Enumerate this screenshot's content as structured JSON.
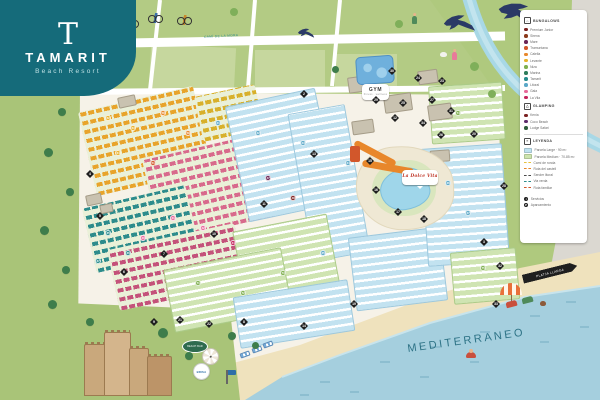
{
  "logo": {
    "initial": "T",
    "title": "TAMARIT",
    "subtitle": "Beach Resort"
  },
  "map": {
    "sea_label": "MEDITERRANEO",
    "road_label": "CAMÍ DE LA MORA",
    "colors": {
      "teal_brand": "#156B7A",
      "sea": "#A5CFDE",
      "sand": "#EFE2BD",
      "field": "#B3CB84",
      "interior": "#F6F2E8",
      "marker": "#1F1F1F"
    }
  },
  "legend": {
    "sections": [
      {
        "icon": "bungalow",
        "title": "BUNGALOWS",
        "items": [
          {
            "c": "#7A2020",
            "label": "Premium Junior"
          },
          {
            "c": "#8C3A1B",
            "label": "Sirena"
          },
          {
            "c": "#6B2457",
            "label": "Mare"
          },
          {
            "c": "#D2572B",
            "label": "Tramuntana"
          },
          {
            "c": "#E8872B",
            "label": "Calella"
          },
          {
            "c": "#E8B22B",
            "label": "Levante"
          },
          {
            "c": "#7FAF4F",
            "label": "Niza"
          },
          {
            "c": "#2F7D5B",
            "label": "Marina"
          },
          {
            "c": "#278C8C",
            "label": "Tamarit"
          },
          {
            "c": "#5BA8C8",
            "label": "Litoral"
          },
          {
            "c": "#E86A9A",
            "label": "Gala"
          },
          {
            "c": "#C4245C",
            "label": "La Vila"
          }
        ]
      },
      {
        "icon": "glamping",
        "title": "GLAMPING",
        "items": [
          {
            "c": "#7A2020",
            "label": "Kenia"
          },
          {
            "c": "#5D2B6B",
            "label": "Coco Beach"
          },
          {
            "c": "#2F5D3B",
            "label": "Lodge Safari"
          }
        ]
      },
      {
        "divider": true,
        "icon": "leyenda",
        "title": "LEYENDA",
        "items": [
          {
            "k": "swatch",
            "c": "#BFE2F0",
            "label": "Parcela Large · 90 m²"
          },
          {
            "k": "swatch",
            "c": "#CDE4AE",
            "label": "Parcela Medium · 70-85 m²"
          },
          {
            "k": "line",
            "c": "#E8C23A",
            "label": "Camí de ronda"
          },
          {
            "k": "line",
            "c": "#E8872B",
            "label": "Ruta del castell"
          },
          {
            "k": "line",
            "c": "#4A4A4A",
            "label": "Sender litoral"
          },
          {
            "k": "line",
            "c": "#2D8C8C",
            "label": "Via verda"
          },
          {
            "k": "line",
            "c": "#D2572B",
            "label": "Ruta familiar"
          }
        ]
      },
      {
        "gap": true,
        "items": [
          {
            "k": "pin",
            "g": "i",
            "label": "Servicios"
          },
          {
            "k": "pin",
            "g": "P",
            "label": "Aparcamiento"
          }
        ]
      }
    ]
  },
  "items": [
    {
      "t": "zone-orange",
      "x": 86,
      "y": 98,
      "w": 118,
      "h": 86,
      "r": -13,
      "c": "#E8A42B",
      "n": "bungalow-zone-orange"
    },
    {
      "t": "zone-orange",
      "x": 198,
      "y": 90,
      "w": 62,
      "h": 46,
      "r": -12,
      "c": "#D8B02B",
      "n": "bungalow-zone-yellow"
    },
    {
      "t": "zone-pink",
      "x": 150,
      "y": 146,
      "w": 118,
      "h": 84,
      "r": -13,
      "c": "#D86A8C",
      "n": "bungalow-zone-pink"
    },
    {
      "t": "zone-teal",
      "x": 88,
      "y": 196,
      "w": 106,
      "h": 66,
      "r": -13,
      "c": "#2D8C8C",
      "n": "bungalow-zone-teal"
    },
    {
      "t": "zone-pink",
      "x": 112,
      "y": 236,
      "w": 130,
      "h": 62,
      "r": -12,
      "c": "#C4527A",
      "n": "bungalow-zone-magenta"
    },
    {
      "t": "zone-blue",
      "x": 236,
      "y": 96,
      "w": 92,
      "h": 118,
      "r": -12,
      "n": "mobilehome-zone"
    },
    {
      "t": "zone-blue",
      "x": 300,
      "y": 108,
      "w": 58,
      "h": 150,
      "r": -10,
      "n": "mobilehome-zone"
    },
    {
      "t": "zone-green",
      "x": 238,
      "y": 222,
      "w": 96,
      "h": 70,
      "r": -11,
      "n": "camping-zone"
    },
    {
      "t": "zone-green",
      "x": 168,
      "y": 258,
      "w": 120,
      "h": 64,
      "r": -11,
      "n": "camping-zone"
    },
    {
      "t": "zone-blue",
      "x": 236,
      "y": 288,
      "w": 116,
      "h": 52,
      "r": -9,
      "n": "mobilehome-zone"
    },
    {
      "t": "zone-blue",
      "x": 352,
      "y": 232,
      "w": 92,
      "h": 74,
      "r": -7,
      "n": "mobilehome-zone"
    },
    {
      "t": "zone-green",
      "x": 430,
      "y": 84,
      "w": 74,
      "h": 58,
      "r": -4,
      "n": "camping-zone"
    },
    {
      "t": "zone-blue",
      "x": 424,
      "y": 146,
      "w": 82,
      "h": 118,
      "r": -4,
      "n": "mobilehome-zone"
    },
    {
      "t": "zone-green",
      "x": 452,
      "y": 250,
      "w": 66,
      "h": 52,
      "r": -5,
      "n": "camping-zone"
    },
    {
      "t": "building",
      "x": 348,
      "y": 76,
      "w": 26,
      "h": 16,
      "r": -8
    },
    {
      "t": "building",
      "x": 384,
      "y": 94,
      "w": 28,
      "h": 18,
      "r": -8
    },
    {
      "t": "building",
      "x": 418,
      "y": 70,
      "w": 20,
      "h": 14,
      "r": -8
    },
    {
      "t": "building",
      "x": 352,
      "y": 120,
      "w": 22,
      "h": 14,
      "r": -8
    },
    {
      "t": "building",
      "x": 428,
      "y": 104,
      "w": 24,
      "h": 16,
      "r": -8
    },
    {
      "t": "building",
      "x": 86,
      "y": 194,
      "w": 16,
      "h": 11,
      "r": -12
    },
    {
      "t": "building",
      "x": 100,
      "y": 204,
      "w": 13,
      "h": 9,
      "r": -12
    },
    {
      "t": "building",
      "x": 118,
      "y": 96,
      "w": 18,
      "h": 11,
      "r": -12
    },
    {
      "t": "building",
      "x": 430,
      "y": 150,
      "w": 20,
      "h": 12,
      "r": -4
    },
    {
      "t": "aqua",
      "x": 356,
      "y": 56,
      "w": 38,
      "h": 28,
      "r": -4,
      "n": "waterpark"
    },
    {
      "t": "deck",
      "x": 356,
      "y": 146,
      "w": 98,
      "h": 84,
      "r": -3,
      "n": "pool-deck"
    },
    {
      "t": "lawn",
      "x": 372,
      "y": 160,
      "w": 64,
      "h": 56
    },
    {
      "t": "pool",
      "x": 380,
      "y": 168,
      "w": 50,
      "h": 42,
      "r": -8,
      "n": "lagoon-pool"
    },
    {
      "t": "slide",
      "x": 352,
      "y": 150,
      "w": 46,
      "h": 7,
      "r": 28,
      "n": "water-slide"
    },
    {
      "t": "slide",
      "x": 362,
      "y": 164,
      "w": 52,
      "h": 7,
      "r": 10,
      "n": "water-slide"
    },
    {
      "t": "slide-tower",
      "x": 350,
      "y": 146,
      "w": 10,
      "h": 16
    },
    {
      "t": "bubble",
      "x": 362,
      "y": 84,
      "w": 27,
      "h": 16,
      "l": "GYM",
      "l2": "fitness · wellness",
      "i": 1,
      "n": "gym-label"
    },
    {
      "t": "bubble bubble-rest",
      "x": 402,
      "y": 170,
      "w": 36,
      "h": 15,
      "l": "La Dolce Vita",
      "i": 1,
      "n": "restaurant-label"
    },
    {
      "t": "tower",
      "x": 84,
      "y": 344,
      "w": 22,
      "h": 52,
      "c": "#C9A87C",
      "n": "castle-tower"
    },
    {
      "t": "tower",
      "x": 104,
      "y": 332,
      "w": 27,
      "h": 64,
      "c": "#D4B58C",
      "n": "castle-keep"
    },
    {
      "t": "tower",
      "x": 129,
      "y": 348,
      "w": 20,
      "h": 48,
      "c": "#C9A87C",
      "n": "castle-tower"
    },
    {
      "t": "tower",
      "x": 147,
      "y": 356,
      "w": 25,
      "h": 40,
      "c": "#BC9468",
      "n": "castle-wall"
    },
    {
      "t": "oval-sign",
      "x": 182,
      "y": 340,
      "w": 26,
      "h": 13,
      "l": "BEACH BAR",
      "i": 1,
      "n": "beach-bar-sign"
    },
    {
      "t": "parasol-top",
      "x": 202,
      "y": 348,
      "w": 17,
      "h": 17,
      "n": "parasol-top-view"
    },
    {
      "t": "brand-badge",
      "x": 193,
      "y": 363,
      "w": 17,
      "h": 17,
      "l": "BRISA",
      "i": 1,
      "n": "brisa-badge"
    },
    {
      "t": "flagpole",
      "x": 226,
      "y": 370,
      "w": 1.6,
      "h": 14,
      "n": "flag"
    },
    {
      "t": "lounger",
      "x": 240,
      "y": 352,
      "w": 10,
      "h": 5,
      "r": -20
    },
    {
      "t": "lounger",
      "x": 252,
      "y": 347,
      "w": 10,
      "h": 5,
      "r": -20
    },
    {
      "t": "lounger",
      "x": 263,
      "y": 342,
      "w": 10,
      "h": 5,
      "r": -20
    },
    {
      "t": "arrow-sign",
      "x": 522,
      "y": 268,
      "w": 56,
      "h": 9,
      "r": -14,
      "l": "PLATJA LLARGA",
      "i": 1,
      "n": "beach-direction-sign"
    },
    {
      "t": "parasol",
      "x": 500,
      "y": 283,
      "w": 22,
      "h": 12,
      "n": "beach-parasol"
    },
    {
      "t": "chair",
      "x": 506,
      "y": 301,
      "w": 11,
      "h": 6,
      "r": -15,
      "c": "#C94F3D",
      "n": "deck-chair"
    },
    {
      "t": "chair",
      "x": 522,
      "y": 297,
      "w": 11,
      "h": 6,
      "r": -15,
      "c": "#4F8A5A",
      "n": "deck-chair"
    },
    {
      "t": "dog",
      "x": 540,
      "y": 301,
      "w": 6,
      "h": 5,
      "c": "#8C5A3A",
      "n": "dog"
    },
    {
      "t": "swimmer",
      "x": 466,
      "y": 352,
      "w": 10,
      "h": 6,
      "n": "swimmer"
    },
    {
      "t": "bike",
      "x": 124,
      "y": 18,
      "w": 15,
      "h": 10,
      "c": "#C94F3D",
      "n": "cyclist"
    },
    {
      "t": "bike",
      "x": 148,
      "y": 13,
      "w": 15,
      "h": 10,
      "c": "#3A6FA8",
      "n": "cyclist"
    },
    {
      "t": "bike",
      "x": 177,
      "y": 15,
      "w": 15,
      "h": 10,
      "c": "#C98A2B",
      "n": "cyclist"
    },
    {
      "t": "fig",
      "x": 412,
      "y": 16,
      "w": 5,
      "h": 8,
      "c": "#4F8A5A",
      "n": "walker"
    },
    {
      "t": "dog",
      "x": 440,
      "y": 52,
      "w": 7,
      "h": 5,
      "c": "#F2F2EE",
      "n": "goat"
    },
    {
      "t": "fig",
      "x": 452,
      "y": 52,
      "w": 5,
      "h": 8,
      "c": "#E87A9A",
      "n": "walker"
    },
    {
      "t": "bird",
      "x": 444,
      "y": 14,
      "w": 30,
      "h": 20,
      "r": -8,
      "n": "swallow-icon"
    },
    {
      "t": "bird",
      "x": 298,
      "y": 28,
      "w": 16,
      "h": 11,
      "r": -4,
      "n": "swallow-icon"
    },
    {
      "t": "bird over-legend",
      "x": 498,
      "y": 2,
      "w": 40,
      "h": 26,
      "r": 8,
      "n": "swallow-icon"
    },
    {
      "t": "tree",
      "x": 58,
      "y": 108,
      "w": 8,
      "h": 8
    },
    {
      "t": "tree",
      "x": 44,
      "y": 148,
      "w": 9,
      "h": 9
    },
    {
      "t": "tree",
      "x": 66,
      "y": 188,
      "w": 8,
      "h": 8
    },
    {
      "t": "tree",
      "x": 40,
      "y": 226,
      "w": 9,
      "h": 9
    },
    {
      "t": "tree",
      "x": 62,
      "y": 266,
      "w": 8,
      "h": 8
    },
    {
      "t": "tree",
      "x": 48,
      "y": 300,
      "w": 9,
      "h": 9
    },
    {
      "t": "tree",
      "x": 86,
      "y": 318,
      "w": 8,
      "h": 8
    },
    {
      "t": "tree",
      "x": 158,
      "y": 328,
      "w": 10,
      "h": 10
    },
    {
      "t": "tree",
      "x": 228,
      "y": 332,
      "w": 8,
      "h": 8
    },
    {
      "t": "tree",
      "x": 252,
      "y": 342,
      "w": 7,
      "h": 7
    },
    {
      "t": "tree",
      "x": 185,
      "y": 352,
      "w": 8,
      "h": 8
    },
    {
      "t": "tree",
      "x": 332,
      "y": 66,
      "w": 7,
      "h": 7
    },
    {
      "t": "tree2",
      "x": 105,
      "y": 14,
      "w": 9,
      "h": 9
    },
    {
      "t": "tree2",
      "x": 230,
      "y": 8,
      "w": 8,
      "h": 8
    },
    {
      "t": "tree2",
      "x": 395,
      "y": 20,
      "w": 8,
      "h": 8
    },
    {
      "t": "tree2",
      "x": 470,
      "y": 62,
      "w": 9,
      "h": 9
    },
    {
      "t": "tree2",
      "x": 545,
      "y": 40,
      "w": 8,
      "h": 8
    },
    {
      "t": "tree2",
      "x": 556,
      "y": 170,
      "w": 9,
      "h": 9
    },
    {
      "t": "tree2",
      "x": 565,
      "y": 200,
      "w": 8,
      "h": 8
    },
    {
      "t": "tree2",
      "x": 488,
      "y": 90,
      "w": 8,
      "h": 8
    },
    {
      "t": "diamond",
      "x": 82,
      "y": 85,
      "l": "1",
      "i": 1
    },
    {
      "t": "diamond",
      "x": 300,
      "y": 90,
      "l": "2",
      "i": 1
    },
    {
      "t": "diamond",
      "x": 388,
      "y": 67,
      "l": "30",
      "i": 1
    },
    {
      "t": "diamond",
      "x": 414,
      "y": 74,
      "l": "24",
      "i": 1
    },
    {
      "t": "diamond",
      "x": 438,
      "y": 77,
      "l": "23",
      "i": 1
    },
    {
      "t": "diamond",
      "x": 372,
      "y": 96,
      "l": "29",
      "i": 1
    },
    {
      "t": "diamond",
      "x": 399,
      "y": 99,
      "l": "25",
      "i": 1
    },
    {
      "t": "diamond",
      "x": 428,
      "y": 96,
      "l": "27",
      "i": 1
    },
    {
      "t": "diamond",
      "x": 447,
      "y": 107,
      "l": "31",
      "i": 1
    },
    {
      "t": "diamond",
      "x": 391,
      "y": 114,
      "l": "12",
      "i": 1
    },
    {
      "t": "diamond",
      "x": 419,
      "y": 119,
      "l": "34",
      "i": 1
    },
    {
      "t": "diamond",
      "x": 437,
      "y": 131,
      "l": "26",
      "i": 1
    },
    {
      "t": "diamond",
      "x": 366,
      "y": 157,
      "l": "15",
      "i": 1
    },
    {
      "t": "diamond",
      "x": 372,
      "y": 186,
      "l": "16",
      "i": 1
    },
    {
      "t": "diamond",
      "x": 394,
      "y": 208,
      "l": "17",
      "i": 1
    },
    {
      "t": "diamond",
      "x": 420,
      "y": 215,
      "l": "18",
      "i": 1
    },
    {
      "t": "diamond",
      "x": 310,
      "y": 150,
      "l": "13",
      "i": 1
    },
    {
      "t": "diamond",
      "x": 260,
      "y": 200,
      "l": "11",
      "i": 1
    },
    {
      "t": "diamond",
      "x": 210,
      "y": 230,
      "l": "10",
      "i": 1
    },
    {
      "t": "diamond",
      "x": 160,
      "y": 250,
      "l": "7",
      "i": 1
    },
    {
      "t": "diamond",
      "x": 120,
      "y": 268,
      "l": "6",
      "i": 1
    },
    {
      "t": "diamond",
      "x": 96,
      "y": 212,
      "l": "5",
      "i": 1
    },
    {
      "t": "diamond",
      "x": 86,
      "y": 170,
      "l": "4",
      "i": 1
    },
    {
      "t": "diamond",
      "x": 150,
      "y": 318,
      "l": "9",
      "i": 1
    },
    {
      "t": "diamond",
      "x": 176,
      "y": 316,
      "l": "21",
      "i": 1
    },
    {
      "t": "diamond",
      "x": 205,
      "y": 320,
      "l": "22",
      "i": 1
    },
    {
      "t": "diamond",
      "x": 240,
      "y": 318,
      "l": "8",
      "i": 1
    },
    {
      "t": "diamond",
      "x": 300,
      "y": 322,
      "l": "14",
      "i": 1
    },
    {
      "t": "diamond",
      "x": 350,
      "y": 300,
      "l": "19",
      "i": 1
    },
    {
      "t": "diamond",
      "x": 470,
      "y": 130,
      "l": "20",
      "i": 1
    },
    {
      "t": "diamond",
      "x": 500,
      "y": 182,
      "l": "28",
      "i": 1
    },
    {
      "t": "diamond",
      "x": 480,
      "y": 238,
      "l": "3",
      "i": 1
    },
    {
      "t": "diamond",
      "x": 496,
      "y": 262,
      "l": "32",
      "i": 1
    },
    {
      "t": "diamond",
      "x": 492,
      "y": 300,
      "l": "33",
      "i": 1
    },
    {
      "t": "badge",
      "x": 105,
      "y": 115,
      "c": "#E8B22B",
      "l": "62",
      "i": 1
    },
    {
      "t": "badge",
      "x": 130,
      "y": 125,
      "c": "#E8B22B",
      "l": "63",
      "i": 1
    },
    {
      "t": "badge",
      "x": 160,
      "y": 110,
      "c": "#E8872B",
      "l": "58",
      "i": 1
    },
    {
      "t": "badge",
      "x": 185,
      "y": 130,
      "c": "#E8872B",
      "l": "59",
      "i": 1
    },
    {
      "t": "badge",
      "x": 115,
      "y": 150,
      "c": "#E8B22B",
      "l": "64",
      "i": 1
    },
    {
      "t": "badge",
      "x": 150,
      "y": 160,
      "c": "#D2572B",
      "l": "51",
      "i": 1
    },
    {
      "t": "badge",
      "x": 170,
      "y": 215,
      "c": "#E86A9A",
      "l": "41",
      "i": 1
    },
    {
      "t": "badge",
      "x": 200,
      "y": 225,
      "c": "#E86A9A",
      "l": "42",
      "i": 1
    },
    {
      "t": "badge",
      "x": 230,
      "y": 240,
      "c": "#C4245C",
      "l": "44",
      "i": 1
    },
    {
      "t": "badge",
      "x": 140,
      "y": 235,
      "c": "#E86A9A",
      "l": "40",
      "i": 1
    },
    {
      "t": "badge",
      "x": 105,
      "y": 230,
      "c": "#278C8C",
      "l": "35",
      "i": 1
    },
    {
      "t": "badge",
      "x": 125,
      "y": 250,
      "c": "#278C8C",
      "l": "36",
      "i": 1
    },
    {
      "t": "badge",
      "x": 95,
      "y": 258,
      "c": "#278C8C",
      "l": "37",
      "i": 1
    },
    {
      "t": "badge",
      "x": 215,
      "y": 120,
      "c": "#5BA8C8",
      "l": "21",
      "i": 1
    },
    {
      "t": "badge",
      "x": 255,
      "y": 130,
      "c": "#5BA8C8",
      "l": "22",
      "i": 1
    },
    {
      "t": "badge",
      "x": 300,
      "y": 140,
      "c": "#5BA8C8",
      "l": "23",
      "i": 1
    },
    {
      "t": "badge",
      "x": 345,
      "y": 160,
      "c": "#5BA8C8",
      "l": "24",
      "i": 1
    },
    {
      "t": "badge",
      "x": 320,
      "y": 250,
      "c": "#5BA8C8",
      "l": "25",
      "i": 1
    },
    {
      "t": "badge",
      "x": 195,
      "y": 280,
      "c": "#7FAF4F",
      "l": "71",
      "i": 1
    },
    {
      "t": "badge",
      "x": 240,
      "y": 290,
      "c": "#7FAF4F",
      "l": "72",
      "i": 1
    },
    {
      "t": "badge",
      "x": 280,
      "y": 270,
      "c": "#7FAF4F",
      "l": "73",
      "i": 1
    },
    {
      "t": "badge",
      "x": 455,
      "y": 110,
      "c": "#7FAF4F",
      "l": "74",
      "i": 1
    },
    {
      "t": "badge",
      "x": 480,
      "y": 265,
      "c": "#7FAF4F",
      "l": "75",
      "i": 1
    },
    {
      "t": "badge",
      "x": 445,
      "y": 180,
      "c": "#5BA8C8",
      "l": "26",
      "i": 1
    },
    {
      "t": "badge",
      "x": 465,
      "y": 210,
      "c": "#5BA8C8",
      "l": "27",
      "i": 1
    },
    {
      "t": "badge",
      "x": 265,
      "y": 175,
      "c": "#6B2457",
      "l": "47",
      "i": 1
    },
    {
      "t": "badge",
      "x": 290,
      "y": 195,
      "c": "#7A2020",
      "l": "48",
      "i": 1
    }
  ]
}
